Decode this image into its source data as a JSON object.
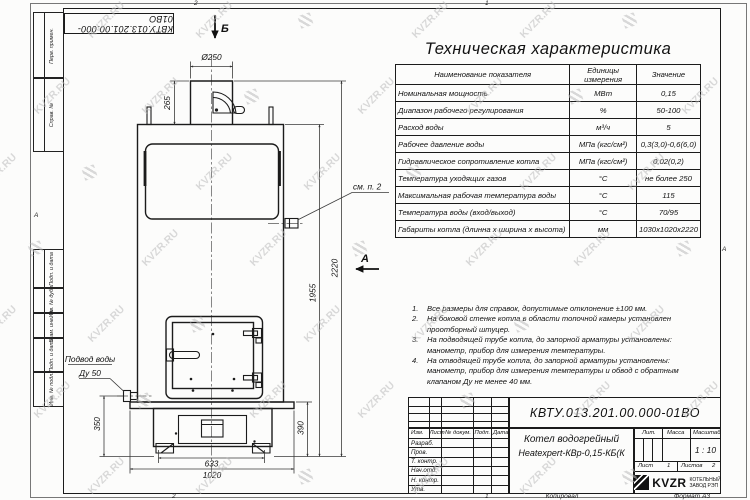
{
  "sheet": {
    "doc_number": "КВТУ.013.201.00.000-01ВО",
    "watermark": "KVZR.RU",
    "zones": {
      "top_left": "2",
      "top_right": "1",
      "bottom_left": "2",
      "bottom_right": "1",
      "side_left": "А",
      "side_right": "А"
    },
    "footer": {
      "copied": "Копировал",
      "format": "Формат А3"
    }
  },
  "left_strip": [
    "Перв. примен.",
    "Справ. №",
    "Подп. и дата",
    "Инв. № дубл.",
    "Взам. инв. №",
    "Подп. и дата",
    "Инв. № подл."
  ],
  "drawing": {
    "view_b": "Б",
    "view_a": "А",
    "callout": "см. п. 2",
    "inlet_line1": "Подвод воды",
    "inlet_line2": "Ду 50",
    "dims": {
      "dia": "Ø250",
      "chimney_h": "265",
      "total_h": "2220",
      "body_h": "1955",
      "inlet_h": "350",
      "base_h": "390",
      "base_w": "633",
      "overall_w": "1020"
    }
  },
  "spec_table": {
    "title": "Техническая характеристика",
    "headers": [
      "Наименование показателя",
      "Единицы измерения",
      "Значение"
    ],
    "rows": [
      [
        "Номинальная мощность",
        "МВт",
        "0,15"
      ],
      [
        "Диапазон рабочего регулирования",
        "%",
        "50-100"
      ],
      [
        "Расход воды",
        "м³/ч",
        "5"
      ],
      [
        "Рабочее давление воды",
        "МПа (кгс/см²)",
        "0,3(3,0)-0,6(6,0)"
      ],
      [
        "Гидравлическое сопротивление котла",
        "МПа (кгс/см²)",
        "0,02(0,2)"
      ],
      [
        "Температура уходящих газов",
        "°С",
        "не более 250"
      ],
      [
        "Максимальная рабочая температура воды",
        "°С",
        "115"
      ],
      [
        "Температура воды (вход/выход)",
        "°С",
        "70/95"
      ],
      [
        "Габариты котла (длинна х ширина х высота)",
        "мм",
        "1030х1020х2220"
      ]
    ]
  },
  "notes": {
    "items": [
      {
        "n": "1.",
        "t": "Все размеры для справок, допустимые отклонение ±100 мм."
      },
      {
        "n": "2.",
        "t": "На боковой стенке котла в области топочной камеры установлен\nпроотборный штуцер."
      },
      {
        "n": "3.",
        "t": "На подводящей трубе котла, до запорной арматуры установлены:\nманометр, прибор для измерения температуры."
      },
      {
        "n": "4.",
        "t": "На отводящей трубе котла, до запорной арматуры установлены:\nманометр, прибор для измерения температуры и обвод с обратным\nклапаном Ду не менее 40 мм."
      }
    ]
  },
  "title_block": {
    "doc_number": "КВТУ.013.201.00.000-01ВО",
    "name_line1": "Котел водогрейный",
    "name_line2": "Heatexpert-КВр-0,15-КБ(К",
    "change_header": [
      "Изм.",
      "Лист",
      "№ докум.",
      "Подп.",
      "Дата"
    ],
    "roles": [
      "Разраб.",
      "Пров.",
      "Т. контр.",
      "Нач.отд.",
      "Н. контр.",
      "Утв."
    ],
    "lit_label": "Лит.",
    "mass_label": "Масса",
    "scale_label": "Масштаб",
    "scale_value": "1 : 10",
    "sheet_label": "Лист",
    "sheet_value": "1",
    "sheets_label": "Листов",
    "sheets_value": "2",
    "company": "KVZR",
    "company_sub1": "КОТЕЛЬНЫЙ",
    "company_sub2": "ЗАВОД РЭП"
  }
}
